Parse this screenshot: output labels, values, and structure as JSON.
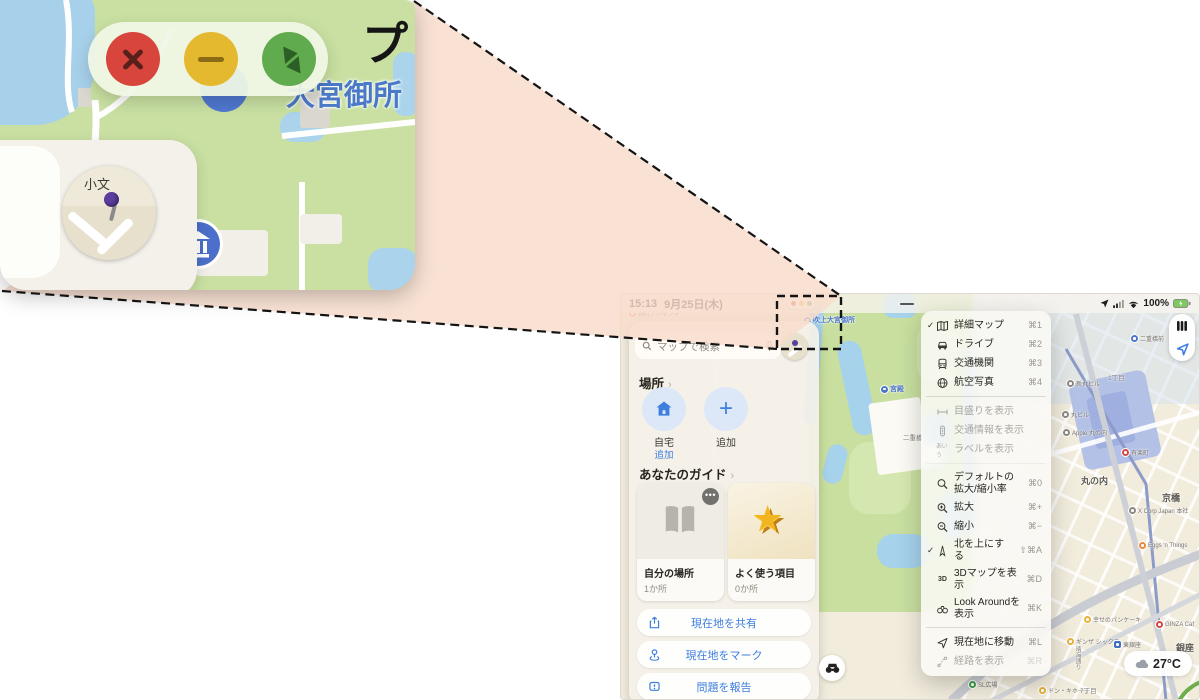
{
  "theme": {
    "accent_blue": "#3d7ede",
    "callout_peach": "#f8dccb",
    "traffic_red": "#d7453c",
    "traffic_yellow": "#e5b92f",
    "traffic_green": "#61ab4f",
    "park_green": "#c8df9f",
    "water_blue": "#a6d2ec",
    "selected_menu_bg": "#403e3c"
  },
  "statusbar": {
    "time": "15:13",
    "date": "9月25日(木)",
    "battery": "100%"
  },
  "menubar": {
    "menus": [
      {
        "label": "マップ"
      },
      {
        "label": "ファイル"
      },
      {
        "label": "編集"
      },
      {
        "label": "表示",
        "active": true
      },
      {
        "label": "ウインドウ"
      },
      {
        "label": "ヘルプ"
      }
    ]
  },
  "view_menu": {
    "items": [
      {
        "icon": "map",
        "label": "詳細マップ",
        "shortcut": "⌘1",
        "checked": true
      },
      {
        "icon": "car",
        "label": "ドライブ",
        "shortcut": "⌘2"
      },
      {
        "icon": "transit",
        "label": "交通機関",
        "shortcut": "⌘3"
      },
      {
        "icon": "aerial",
        "label": "航空写真",
        "shortcut": "⌘4",
        "divider": true
      },
      {
        "icon": "scale",
        "label": "目盛りを表示",
        "disabled": true
      },
      {
        "icon": "traffic",
        "label": "交通情報を表示",
        "disabled": true
      },
      {
        "icon": "labels",
        "label": "ラベルを表示",
        "disabled": true,
        "divider": true
      },
      {
        "icon": "zoomdef",
        "label": "デフォルトの拡大/縮小率",
        "shortcut": "⌘0"
      },
      {
        "icon": "zoomin",
        "label": "拡大",
        "shortcut": "⌘+"
      },
      {
        "icon": "zoomout",
        "label": "縮小",
        "shortcut": "⌘−"
      },
      {
        "icon": "compass",
        "label": "北を上にする",
        "shortcut": "⇧⌘A",
        "checked": true
      },
      {
        "icon": "threed",
        "label": "3Dマップを表示",
        "shortcut": "⌘D"
      },
      {
        "icon": "lookaround",
        "label": "Look Aroundを表示",
        "shortcut": "⌘K",
        "divider": true
      },
      {
        "icon": "location",
        "label": "現在地に移動",
        "shortcut": "⌘L"
      },
      {
        "icon": "route",
        "label": "経路を表示",
        "shortcut": "⌘R",
        "disabled": true
      }
    ]
  },
  "sidebar": {
    "search_placeholder": "マップで検索",
    "places": {
      "heading": "場所",
      "items": [
        {
          "icon": "home",
          "label": "自宅",
          "sub": "追加"
        },
        {
          "icon": "plus",
          "label": "追加"
        }
      ]
    },
    "guides": {
      "heading": "あなたのガイド",
      "cards": [
        {
          "icon": "book",
          "title": "自分の場所",
          "count": "1か所",
          "more": true
        },
        {
          "icon": "star",
          "title": "よく使う項目",
          "count": "0か所",
          "star": true
        }
      ]
    },
    "actions": [
      {
        "icon": "share",
        "label": "現在地を共有"
      },
      {
        "icon": "mark",
        "label": "現在地をマーク"
      },
      {
        "icon": "report",
        "label": "問題を報告"
      }
    ]
  },
  "map": {
    "weather": "27°C",
    "labels": [
      {
        "x": 8,
        "y": 15,
        "text": "麹町アジャンタ",
        "dot": "dot-orange"
      },
      {
        "x": 183,
        "y": 21,
        "text": "吹上大宮御所",
        "dot": "dot-blue",
        "cls": "lab-blue"
      },
      {
        "x": 260,
        "y": 90,
        "text": "宮殿",
        "dot": "dot-blue",
        "cls": "lab-blue"
      },
      {
        "x": 282,
        "y": 138,
        "text": "二重橋",
        "cls": "lab-plain"
      },
      {
        "x": 510,
        "y": 40,
        "text": "二重橋前",
        "dot": "dot-blue"
      },
      {
        "x": 487,
        "y": 78,
        "text": "1丁目",
        "cls": "lab-plain"
      },
      {
        "x": 446,
        "y": 85,
        "text": "新丸ビル",
        "dot": "dot-gray"
      },
      {
        "x": 441,
        "y": 116,
        "text": "丸ビル",
        "dot": "dot-gray"
      },
      {
        "x": 442,
        "y": 134,
        "text": "Apple 丸の内",
        "dot": "dot-gray"
      },
      {
        "x": 460,
        "y": 180,
        "text": "丸の内",
        "cls": "lab-district"
      },
      {
        "x": 501,
        "y": 154,
        "text": "有楽町",
        "dot": "dot-red"
      },
      {
        "x": 541,
        "y": 197,
        "text": "京橋",
        "cls": "lab-district"
      },
      {
        "x": 508,
        "y": 212,
        "text": "X Corp Japan 本社",
        "dot": "dot-gray"
      },
      {
        "x": 518,
        "y": 248,
        "text": "Eggs 'n Things",
        "dot": "dot-orange"
      },
      {
        "x": 463,
        "y": 321,
        "text": "幸せのパンケーキ",
        "dot": "dot-yellow"
      },
      {
        "x": 446,
        "y": 343,
        "text": "ギンザ シックス",
        "dot": "dot-yellow"
      },
      {
        "x": 493,
        "y": 346,
        "text": "東銀座",
        "dot": "sq-blue"
      },
      {
        "x": 535,
        "y": 327,
        "text": "GINZA Caf",
        "dot": "dot-red"
      },
      {
        "x": 555,
        "y": 347,
        "text": "銀座",
        "cls": "lab-district"
      },
      {
        "x": 348,
        "y": 386,
        "text": "SL広場",
        "dot": "dot-green"
      },
      {
        "x": 418,
        "y": 392,
        "text": "ドン・キホーテ",
        "dot": "dot-yellow"
      },
      {
        "x": 459,
        "y": 391,
        "text": "7丁目",
        "cls": "lab-plain"
      },
      {
        "x": 452,
        "y": 352,
        "text": "晴海通り",
        "cls": "lab-road"
      }
    ]
  },
  "callout": {
    "magnified_title_fragment": "プ",
    "poi_label": "大宮御所",
    "avatar_text": "小文"
  }
}
